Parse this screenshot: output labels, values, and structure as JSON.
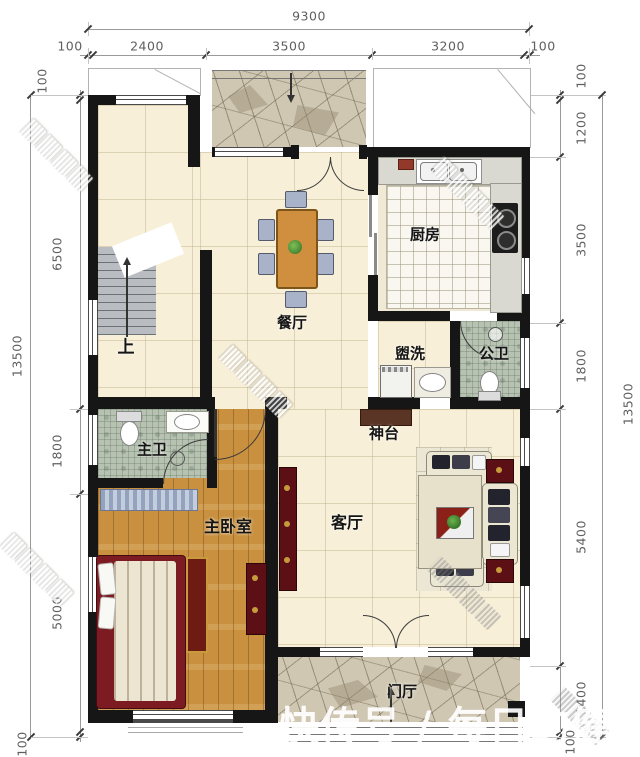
{
  "title": "两层住宅一层平面图",
  "dimensions": {
    "top": {
      "total": "9300",
      "segments": [
        "100",
        "2400",
        "3500",
        "3200",
        "100"
      ]
    },
    "left": {
      "total": "13500",
      "segments": [
        "100",
        "6500",
        "1800",
        "5000",
        "100"
      ]
    },
    "right": {
      "total": "13500",
      "segments": [
        "100",
        "1200",
        "3500",
        "1800",
        "5400",
        "1400",
        "100"
      ]
    }
  },
  "rooms": {
    "kitchen": "厨房",
    "dining": "餐厅",
    "laundry": "盥洗",
    "public_bath": "公卫",
    "altar": "神台",
    "master_bath": "主卫",
    "master_bedroom": "主卧室",
    "living": "客厅",
    "foyer": "门厅",
    "stairs_up": "上"
  },
  "watermark": {
    "platform": "快传号 / 每日的健"
  },
  "colors": {
    "wall": "#161616",
    "tile_beige": "#f7efd8",
    "tile_green": "#b7c2b2",
    "wood": "#c8903f",
    "stone": "#cfc7b2",
    "accent_red": "#5c1016",
    "table_orange": "#cf8f3e",
    "chair_blue": "#a8b2c8"
  }
}
